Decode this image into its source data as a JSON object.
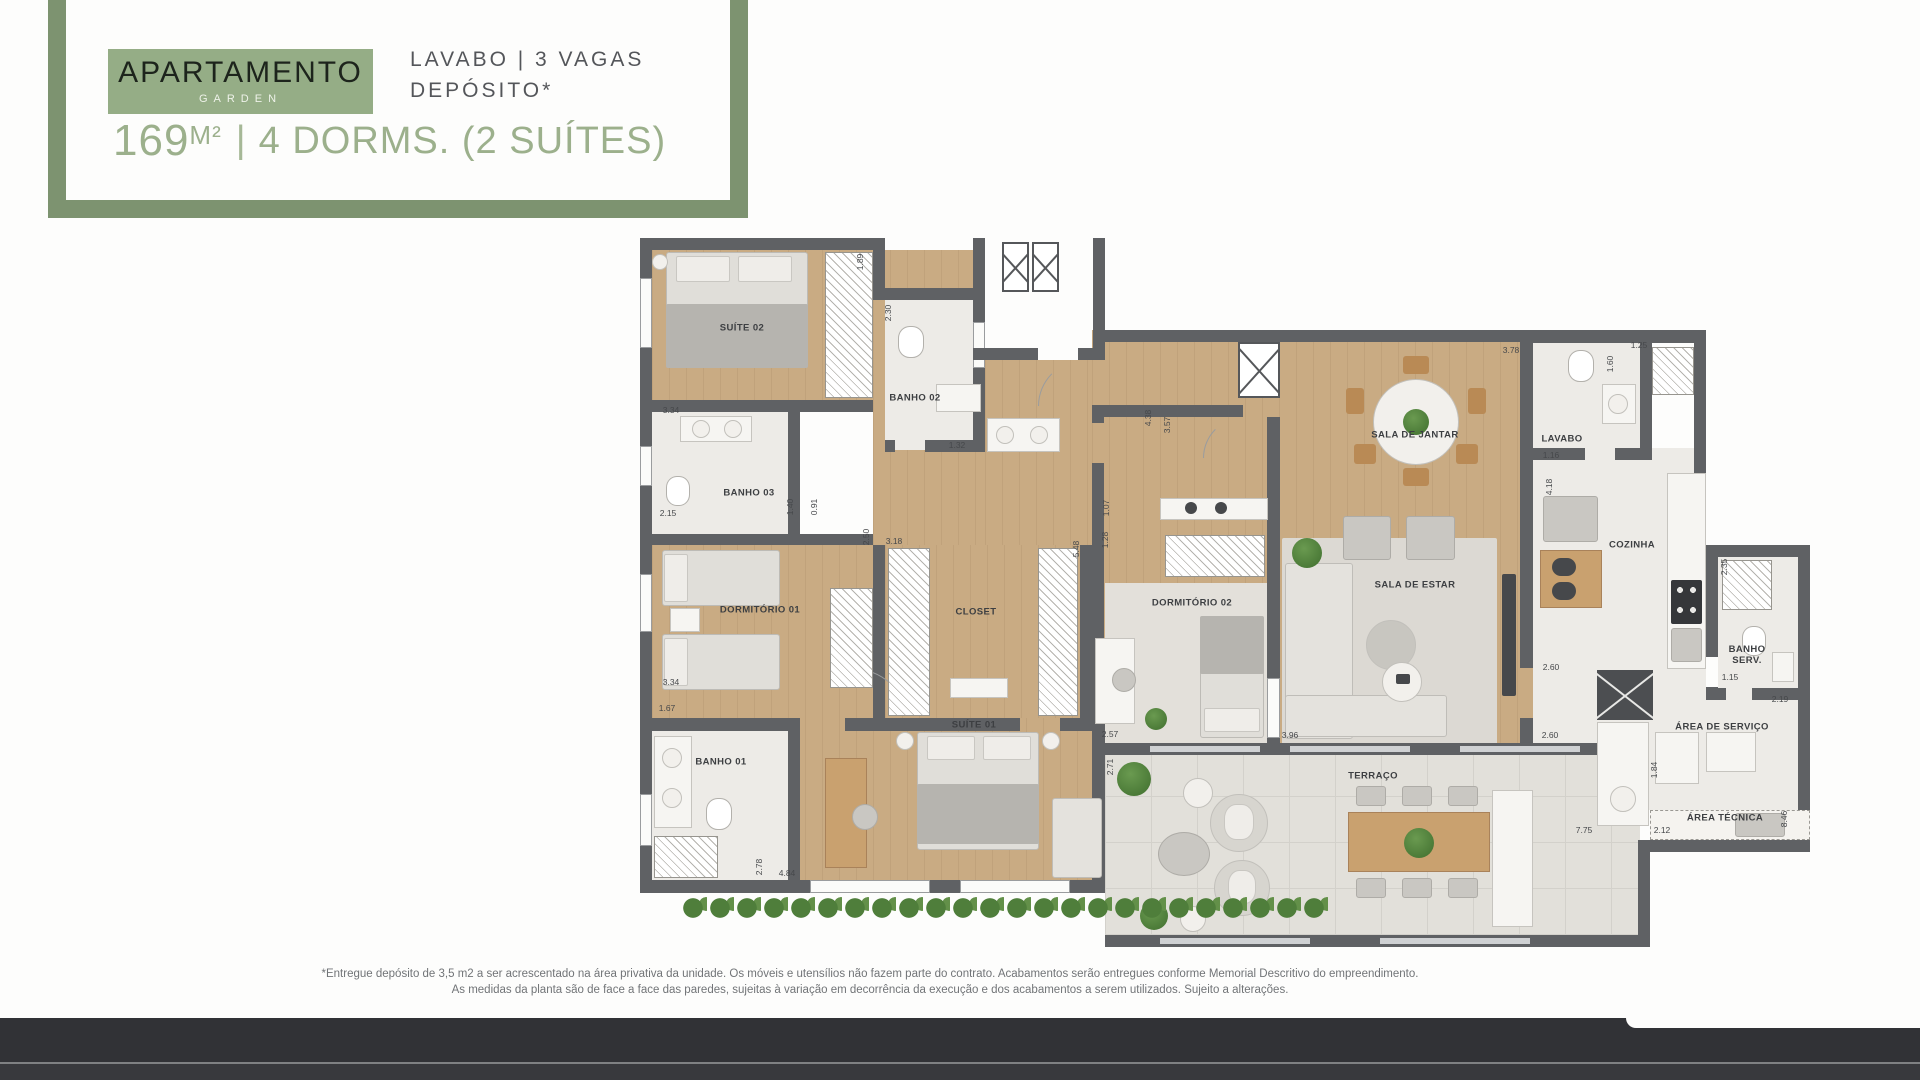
{
  "header": {
    "badge_title": "APARTAMENTO",
    "badge_subtitle": "GARDEN",
    "features": "LAVABO | 3 VAGAS\nDEPÓSITO*",
    "area_value": "169",
    "area_unit": "M²",
    "separator": "|",
    "dorms_text": "4 DORMS. (2 SUÍTES)"
  },
  "colors": {
    "frame_green": "#7d9370",
    "badge_green": "#95ad86",
    "headline_green": "#9cb08c",
    "features_gray": "#54565a",
    "wall_gray": "#5f6164",
    "wood_floor": "#c9ab83",
    "footer_band": "#313236"
  },
  "plan": {
    "rooms": [
      {
        "label": "SUÍTE 02",
        "x": 102,
        "y": 90
      },
      {
        "label": "BANHO 02",
        "x": 275,
        "y": 160
      },
      {
        "label": "BANHO 03",
        "x": 109,
        "y": 255
      },
      {
        "label": "DORMITÓRIO 01",
        "x": 120,
        "y": 372
      },
      {
        "label": "CLOSET",
        "x": 336,
        "y": 374
      },
      {
        "label": "BANHO 01",
        "x": 81,
        "y": 524
      },
      {
        "label": "SUÍTE 01",
        "x": 334,
        "y": 487
      },
      {
        "label": "DORMITÓRIO 02",
        "x": 552,
        "y": 365
      },
      {
        "label": "SALA DE JANTAR",
        "x": 775,
        "y": 197
      },
      {
        "label": "LAVABO",
        "x": 922,
        "y": 201
      },
      {
        "label": "SALA DE ESTAR",
        "x": 775,
        "y": 347
      },
      {
        "label": "COZINHA",
        "x": 992,
        "y": 307
      },
      {
        "label": "BANHO\nSERV.",
        "x": 1107,
        "y": 417
      },
      {
        "label": "ÁREA DE SERVIÇO",
        "x": 1082,
        "y": 489
      },
      {
        "label": "ÁREA TÉCNICA",
        "x": 1085,
        "y": 580
      },
      {
        "label": "TERRAÇO",
        "x": 733,
        "y": 538
      }
    ],
    "dims": [
      {
        "text": "3.34",
        "x": 31,
        "y": 172
      },
      {
        "text": "1.89",
        "x": 220,
        "y": 24,
        "v": 1
      },
      {
        "text": "2.30",
        "x": 248,
        "y": 75,
        "v": 1
      },
      {
        "text": "1.32",
        "x": 317,
        "y": 207
      },
      {
        "text": "2.15",
        "x": 28,
        "y": 275
      },
      {
        "text": "1.40",
        "x": 150,
        "y": 269,
        "v": 1
      },
      {
        "text": "0.91",
        "x": 174,
        "y": 269,
        "v": 1
      },
      {
        "text": "3.34",
        "x": 31,
        "y": 444
      },
      {
        "text": "2.50",
        "x": 226,
        "y": 299,
        "v": 1
      },
      {
        "text": "3.18",
        "x": 254,
        "y": 303
      },
      {
        "text": "5.48",
        "x": 436,
        "y": 311,
        "v": 1
      },
      {
        "text": "1.67",
        "x": 27,
        "y": 470
      },
      {
        "text": "2.78",
        "x": 119,
        "y": 629,
        "v": 1
      },
      {
        "text": "4.84",
        "x": 147,
        "y": 635
      },
      {
        "text": "2.57",
        "x": 470,
        "y": 496
      },
      {
        "text": "2.71",
        "x": 470,
        "y": 529,
        "v": 1
      },
      {
        "text": "1.07",
        "x": 466,
        "y": 270,
        "v": 1
      },
      {
        "text": "1.28",
        "x": 465,
        "y": 302,
        "v": 1
      },
      {
        "text": "4.38",
        "x": 508,
        "y": 180,
        "v": 1
      },
      {
        "text": "3.57",
        "x": 527,
        "y": 187,
        "v": 1
      },
      {
        "text": "3.78",
        "x": 871,
        "y": 112
      },
      {
        "text": "1.25",
        "x": 999,
        "y": 107
      },
      {
        "text": "1.60",
        "x": 970,
        "y": 126,
        "v": 1
      },
      {
        "text": "1.16",
        "x": 911,
        "y": 217
      },
      {
        "text": "4.18",
        "x": 909,
        "y": 249,
        "v": 1
      },
      {
        "text": "2.35",
        "x": 1084,
        "y": 329,
        "v": 1
      },
      {
        "text": "1.15",
        "x": 1090,
        "y": 439
      },
      {
        "text": "2.19",
        "x": 1140,
        "y": 461
      },
      {
        "text": "2.60",
        "x": 911,
        "y": 429
      },
      {
        "text": "2.60",
        "x": 910,
        "y": 497
      },
      {
        "text": "1.84",
        "x": 1014,
        "y": 532,
        "v": 1
      },
      {
        "text": "3.96",
        "x": 650,
        "y": 497
      },
      {
        "text": "7.75",
        "x": 944,
        "y": 592
      },
      {
        "text": "2.12",
        "x": 1022,
        "y": 592
      },
      {
        "text": "8.46",
        "x": 1144,
        "y": 581,
        "v": 1
      }
    ]
  },
  "footnote": {
    "line1": "*Entregue depósito de 3,5 m2 a ser acrescentado na área privativa da unidade. Os móveis e utensílios não fazem parte do contrato. Acabamentos serão entregues conforme Memorial Descritivo do empreendimento.",
    "line2": "As medidas da planta são de face a face das paredes, sujeitas à variação em decorrência da execução e dos acabamentos a serem utilizados. Sujeito a alterações."
  }
}
